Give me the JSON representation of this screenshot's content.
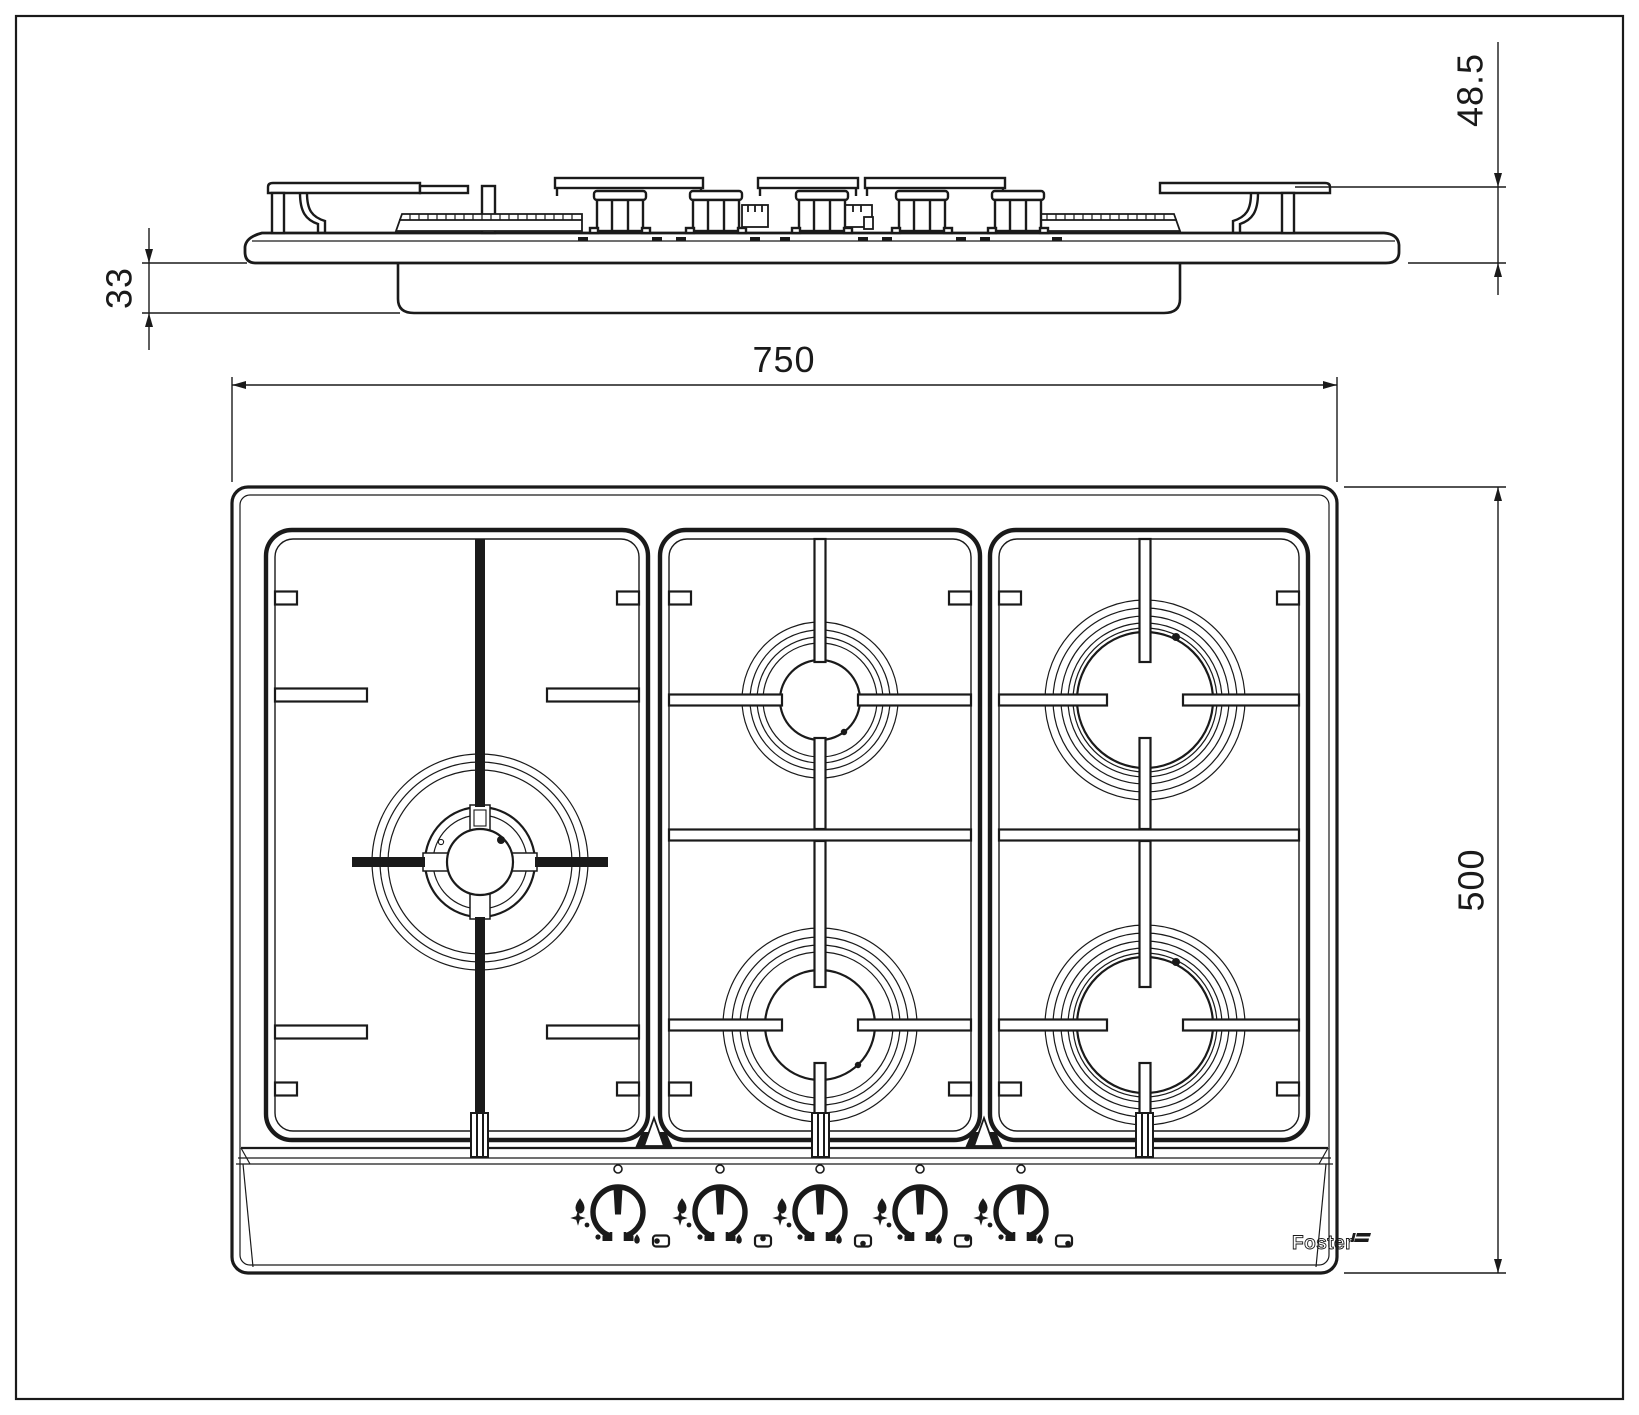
{
  "document": {
    "type": "technical-dimension-drawing",
    "subject": "5-burner gas hob, side elevation and top plan view"
  },
  "dimensions": {
    "width": "750",
    "depth": "500",
    "height_upper": "48.5",
    "height_lower": "33"
  },
  "logo": {
    "text": "Foster"
  },
  "burners": [
    {
      "name": "wok-burner-left",
      "rings": 3,
      "position": "left-center"
    },
    {
      "name": "burner-rear-middle",
      "position": "middle-rear"
    },
    {
      "name": "burner-front-middle",
      "position": "middle-front"
    },
    {
      "name": "burner-rear-right",
      "position": "right-rear"
    },
    {
      "name": "burner-front-right",
      "position": "right-front"
    }
  ],
  "knobs": [
    {
      "id": 1,
      "controls": "wok-burner-left",
      "position_icon": "dot-left"
    },
    {
      "id": 2,
      "controls": "burner-rear-middle",
      "position_icon": "dot-top"
    },
    {
      "id": 3,
      "controls": "burner-front-middle",
      "position_icon": "dot-bottom"
    },
    {
      "id": 4,
      "controls": "burner-rear-right",
      "position_icon": "dot-top-right"
    },
    {
      "id": 5,
      "controls": "burner-front-right",
      "position_icon": "dot-bottom-right"
    }
  ],
  "icons": {
    "knob_left_icons": [
      "flame-large-icon",
      "star-spark-icon"
    ],
    "knob_bottom_icon": "flame-small-icon",
    "knob_top_icon": "off-position-icon"
  },
  "colors": {
    "ink": "#1a1a1a",
    "paper": "#ffffff"
  }
}
